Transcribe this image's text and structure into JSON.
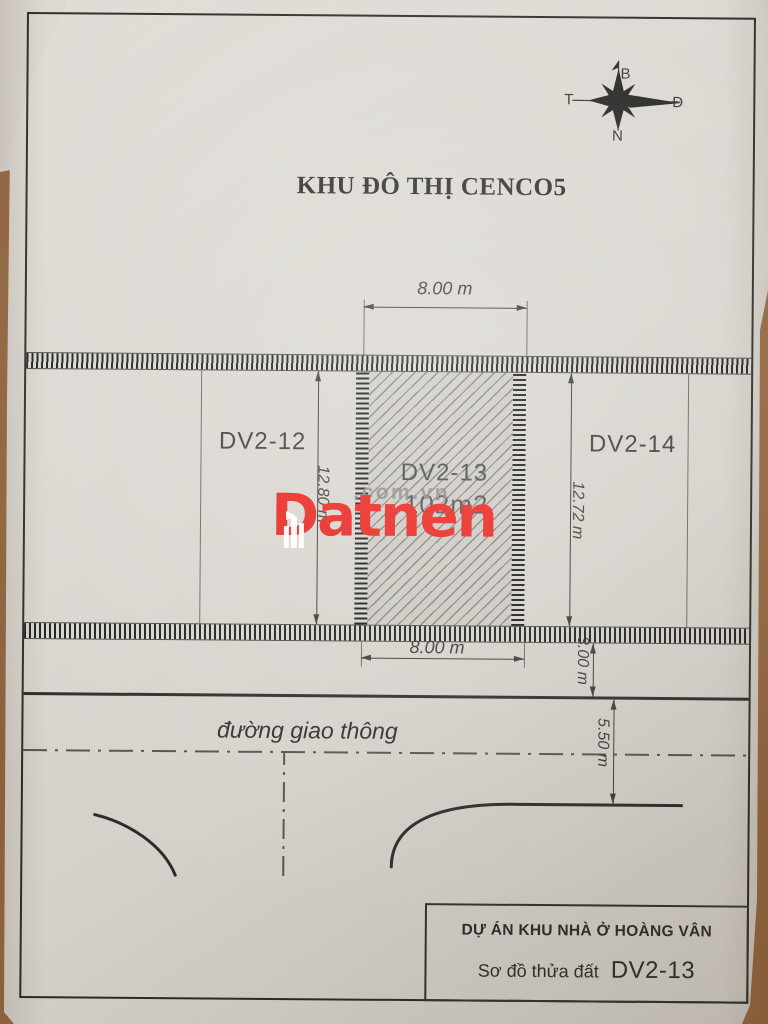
{
  "title": "KHU ĐÔ THỊ CENCO5",
  "compass": {
    "b": "B",
    "d": "Đ",
    "n": "N",
    "t": "T"
  },
  "parcels": {
    "left_id": "DV2-12",
    "center_id": "DV2-13",
    "center_area": "102m2",
    "right_id": "DV2-14"
  },
  "dims": {
    "top_width": "8.00 m",
    "bottom_width": "8.00 m",
    "left_depth": "12.80 m",
    "right_depth": "12.72 m",
    "sidewalk": "3.00 m",
    "road_width": "5.50 m"
  },
  "road_label": "đường giao thông",
  "watermark": {
    "brand": "Datnen",
    "suffix": ".com.vn"
  },
  "title_block": {
    "project": "DỰ ÁN KHU NHÀ Ở HOÀNG VÂN",
    "sheet_type": "Sơ đồ thửa đất",
    "parcel_code": "DV2-13"
  },
  "colors": {
    "watermark_red": "#e8211a",
    "paper": "#d9d5cf",
    "table": "#96663e",
    "ink": "#2b2b29"
  }
}
